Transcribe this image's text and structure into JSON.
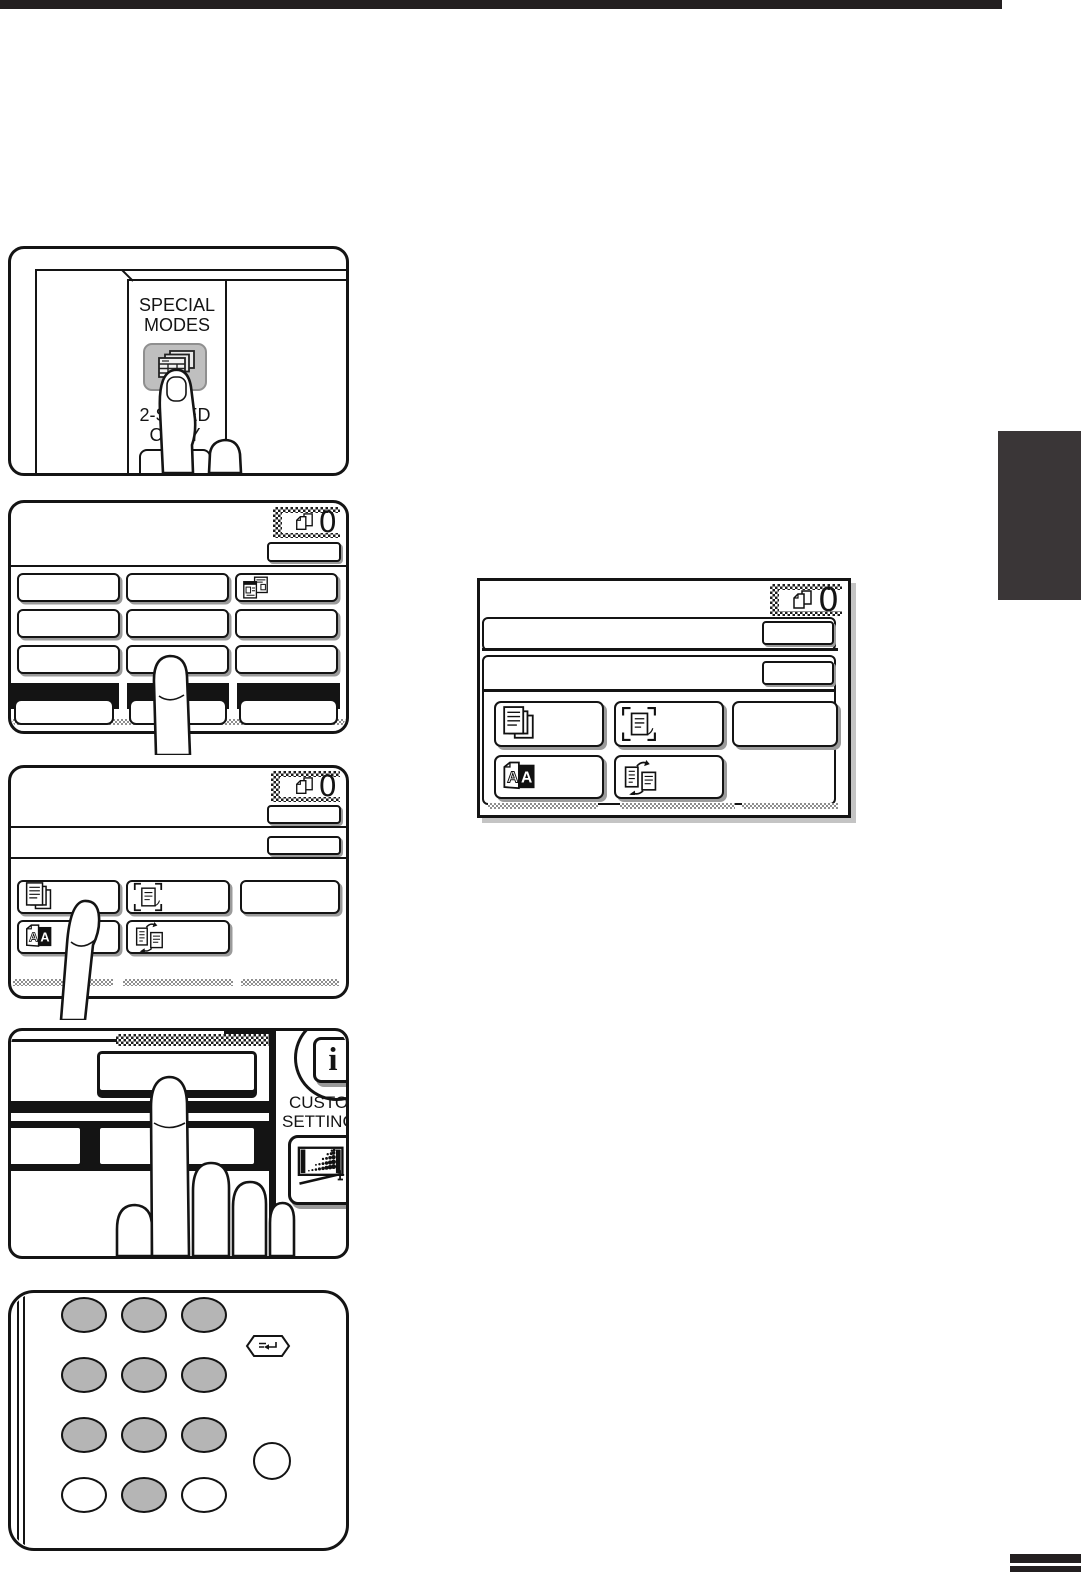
{
  "page_chrome": {
    "top_bar_color": "#231f20",
    "section_tab_color": "#3a3637",
    "page_edge_bar_color": "#231f20"
  },
  "icons": {
    "info_glyph": "i",
    "dual_page_letter": "A",
    "special-modes-key-icon": "stacked sheets with table grid",
    "copies-count-icon": "two overlapping pages",
    "id-card-copy-icon": "two id cards",
    "margin-shift-icon": "stacked pages",
    "erase-icon": "page in corner brackets",
    "dual-page-copy-icon": "white A page and black A page",
    "two-sided-copy-icon": "two pages with cycle arrows",
    "display-contrast-icon": "screen with dot ramp and adjuster",
    "program-key-icon": "return arrow glyph"
  },
  "step_panels": {
    "special_modes_key": {
      "label": [
        "SPECIAL",
        "MODES"
      ],
      "partial_key_label": [
        "2-SIDED",
        "COPY"
      ]
    },
    "base_screen": {
      "copies_count": "0"
    },
    "special_modes_screen": {
      "copies_count": "0"
    },
    "result_screen": {
      "copies_count": "0"
    },
    "zoomed_panel": {
      "custom_settings_label": [
        "CUSTOM",
        "SETTINGS"
      ]
    }
  }
}
